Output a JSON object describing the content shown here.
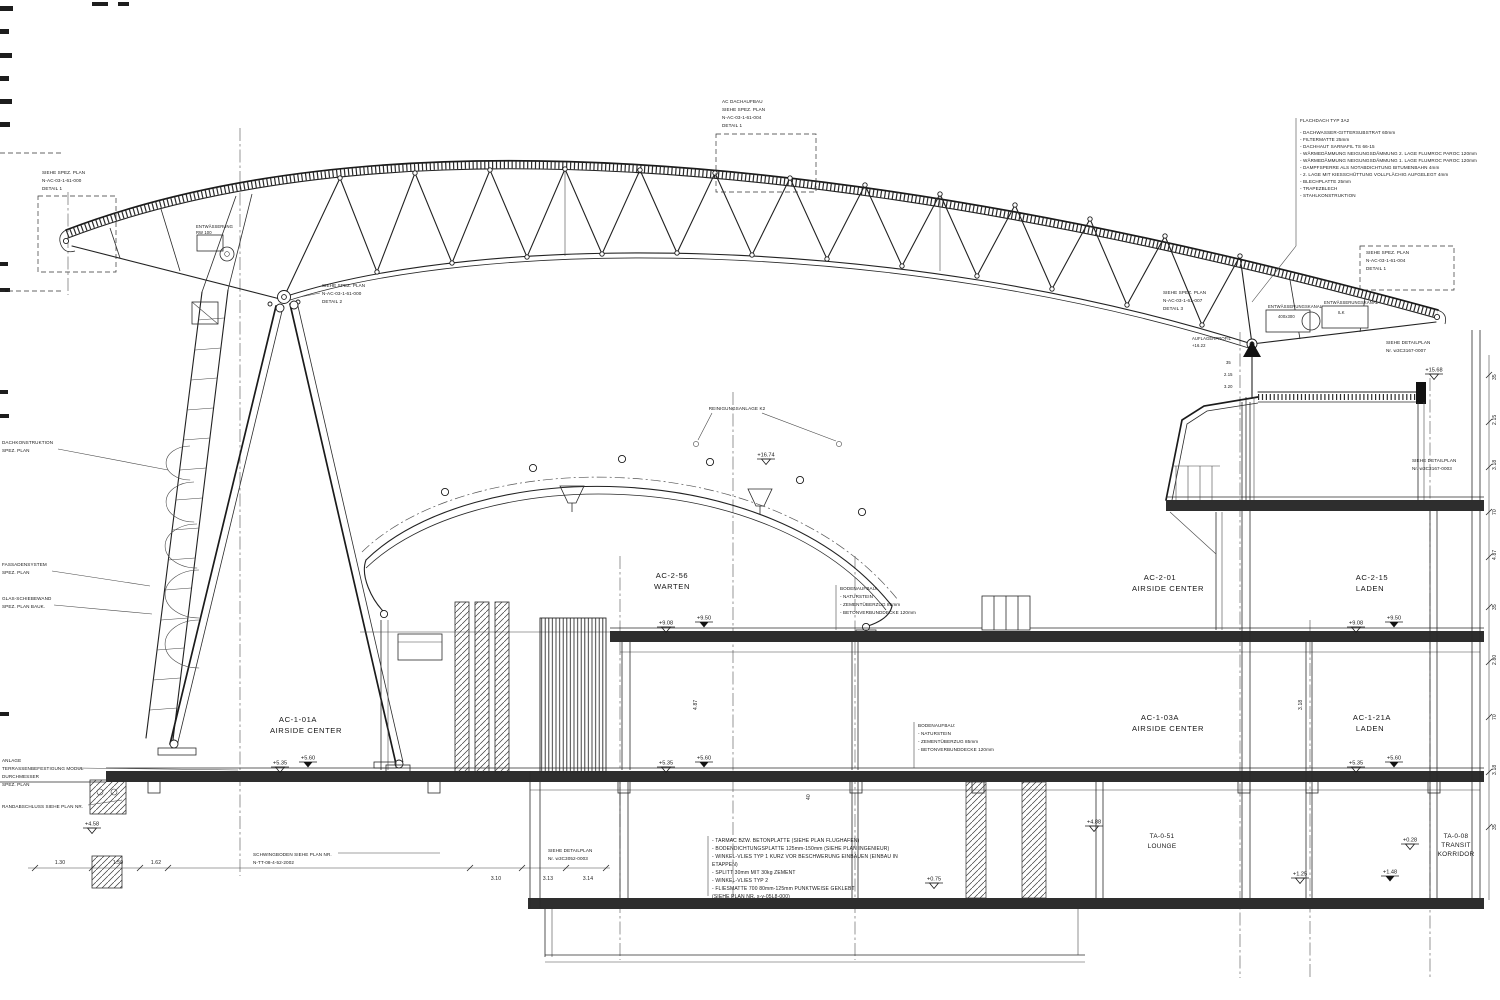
{
  "drawing": {
    "rooms": {
      "ac256_id": "AC-2-56",
      "ac256_name": "WARTEN",
      "ac201_id": "AC-2-01",
      "ac201_name": "AIRSIDE  CENTER",
      "ac215_id": "AC-2-15",
      "ac215_name": "LADEN",
      "ac101a_id": "AC-1-01A",
      "ac101a_name": "AIRSIDE  CENTER",
      "ac103a_id": "AC-1-03A",
      "ac103a_name": "AIRSIDE  CENTER",
      "ac121a_id": "AC-1-21A",
      "ac121a_name": "LADEN",
      "ta051_id": "TA-0-51",
      "ta051_name": "LOUNGE",
      "ta008_id": "TA-0-08",
      "ta008_name": "TRANSIT",
      "ta008_name2": "KORRIDOR"
    },
    "refs": {
      "roof_top": [
        "AC DACHAUFBAU",
        "SIEHE SPEZ. PLAN",
        "N-AC-03-1-61-004",
        "DETAIL 1"
      ],
      "left": [
        "SIEHE SPEZ. PLAN",
        "N-AC-03-1-61-000",
        "DETAIL 1"
      ],
      "node": [
        "SIEHE SPEZ. PLAN",
        "N-AC-03-1-61-000",
        "DETAIL 2"
      ],
      "right": [
        "SIEHE SPEZ. PLAN",
        "N-AC-03-1-61-007",
        "DETAIL 3"
      ],
      "far_right": [
        "SIEHE SPEZ. PLAN",
        "N-AC-03-1-61-004",
        "DETAIL 1"
      ],
      "detail_r1": [
        "SIEHE DETAILPLAN",
        "Nr. w3C3167-0007"
      ],
      "detail_r2": [
        "SIEHE DETAILPLAN",
        "Nr. w3C3167-0003"
      ],
      "detail_b": [
        "SIEHE DETAILPLAN",
        "Nr. w3C3052-0003"
      ],
      "schwing": [
        "SCHWINGBODEN SIEHE PLAN NR.",
        "N-TT-08-4-52-2002"
      ]
    },
    "notes": {
      "flachdach": [
        "FLACHDACH TYP 3A2",
        "- DACHWASSER-GITTERSUBSTRAT 60mm",
        "- FILTERMATTE 25mm",
        "- DACHHAUT SARNAFIL TS 66-15",
        "- WÄRMEDÄMMUNG NEIGUNGSDÄMMUNG 2. LAGE FLUMROC PAROC 120mm",
        "- WÄRMEDÄMMUNG NEIGUNGSDÄMMUNG 1. LAGE FLUMROC PAROC 120mm",
        "- DAMPFSPERRE ALS NOTABDICHTUNG BITUMENBAHN 4mm",
        "- 2. LAGE MIT KIESSCHÜTTUNG VOLLFLÄCHIG AUFGELEGT 4mm",
        "- BLECHPLATTE 25mm",
        "- TRAPEZBLECH",
        "- STAHLKONSTRUKTION"
      ],
      "boden1": [
        "BODENAUFBAU:",
        "- NATURSTEIN",
        "- ZEMENTÜBERZUG 85mm",
        "- BETONVERBUNDDECKE 120mm"
      ],
      "boden2": [
        "BODENAUFBAU:",
        "- NATURSTEIN",
        "- ZEMENTÜBERZUG 85mm",
        "- BETONVERBUNDDECKE 120mm"
      ],
      "tarmac": [
        "- TARMAC BZW. BETONPLATTE (SIEHE PLAN FLUGHAFEN)",
        "- BODENDICHTUNGSPLATTE 125mm-150mm (SIEHE PLAN INGENIEUR)",
        "- WINKEL-VLIES TYP 1 KURZ VOR BESCHWERUNG EINBAUEN (EINBAU IN",
        "  ETAPPEN)",
        "- SPLITT 30mm MIT 30kg ZEMENT",
        "- WINKEL-VLIES TYP 2",
        "- FLIESMATTE 700 80mm-125mm PUNKTWEISE GEKLEBT",
        "  (SIEHE PLAN NR. x-y-05L8-000)"
      ],
      "entw1": [
        "ENTWÄSSERUNGSKANAL",
        "400x300"
      ],
      "entw2": [
        "ENTWÄSSERUNGSKANAL",
        "ILK"
      ],
      "reinigung": "REINIGUNGSANLAGE K2",
      "roof_drain": [
        "ENTWÄSSERUNG",
        "RW 100"
      ],
      "auflager": [
        "AUFLAGERPROFIL",
        "+16.22"
      ]
    },
    "margin": {
      "dach": [
        "DACHKONSTRUKTION",
        "SPEZ. PLAN"
      ],
      "fassade": [
        "FASSADENSYSTEM",
        "SPEZ. PLAN"
      ],
      "schiebe": [
        "GLAS-SCHIEBEWAND",
        "SPEZ. PLAN BAUK."
      ],
      "anlage": [
        "ANLAGE",
        "TERRASSENBEFESTIGUNG MODUL",
        "DURCHMESSER",
        "SPEZ. PLAN"
      ],
      "rand": "RANDABSCHLUSS SIEHE PLAN NR."
    },
    "elevations": {
      "l2a": "+9.08",
      "l2b": "+9.50",
      "l2c": "+9.08",
      "l2d": "+9.50",
      "l1a": "+5.35",
      "l1b": "+5.60",
      "l1c": "+5.35",
      "l1d": "+5.60",
      "l1e": "+5.35",
      "l1f": "+5.60",
      "e488": "+4.88",
      "e458": "+4.58",
      "e028": "+0.28",
      "e125": "+1.25",
      "e148": "+1.48",
      "e075": "+0.75",
      "e1568": "+15.68",
      "e1674": "+16.74"
    },
    "dims": {
      "bl1": "1.30",
      "bl2": "1.50",
      "bl3": "1.62",
      "bm1": "3.10",
      "bm2": "3.13",
      "bm3": "3.14",
      "right_chain": [
        "35",
        "2.15",
        "3.18",
        "70",
        "4.87",
        "35",
        "2.80",
        "70",
        "3.18",
        "35"
      ],
      "col1": "4.87",
      "col2": "3.18",
      "col3": "40",
      "rc1": "35",
      "rc2": "2.15",
      "rc3": "3.20"
    }
  }
}
